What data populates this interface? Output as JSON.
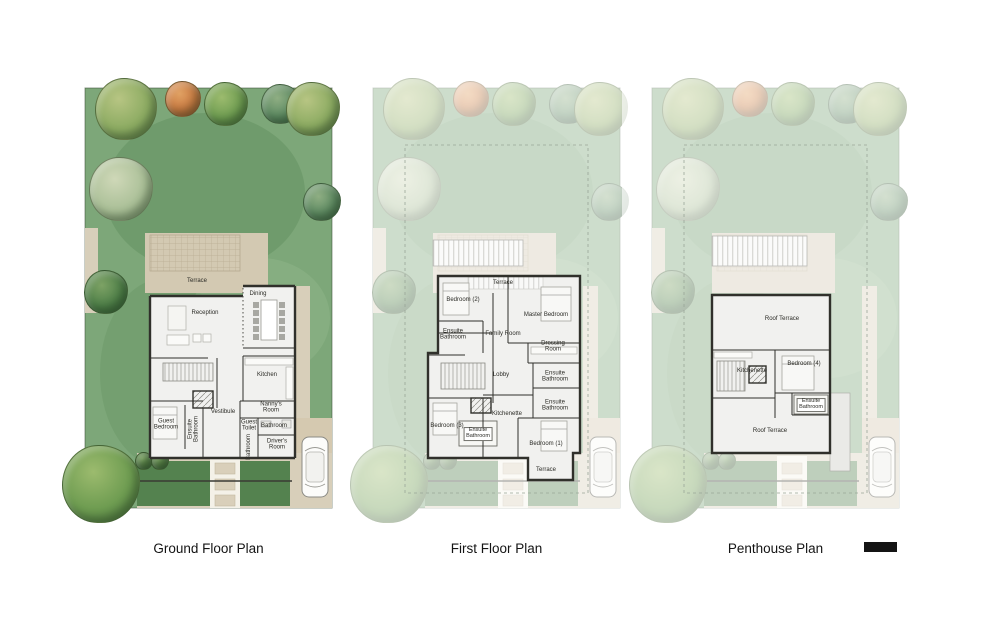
{
  "page": {
    "background": "#ffffff"
  },
  "colors": {
    "page_bg": "#ffffff",
    "lawn": "#7da779",
    "lawn_shade": "#5f8f5e",
    "path_beige": "#d8cfba",
    "terrace_beige": "#d3c9b2",
    "driveway": "#d5c9b0",
    "planting": "#54824f",
    "wall": "#30302b",
    "floor": "#f1f1ef",
    "label_text": "#2b2b26",
    "caption_text": "#141414",
    "wash": "rgba(255,255,255,0.62)",
    "scale_bar": "#141414"
  },
  "plans": [
    {
      "id": "ground",
      "caption": "Ground Floor Plan",
      "faded": false,
      "rooms": [
        {
          "t": "Terrace",
          "x": 142,
          "y": 218
        },
        {
          "t": "Dining",
          "x": 203,
          "y": 231
        },
        {
          "t": "Reception",
          "x": 150,
          "y": 250
        },
        {
          "t": "Kitchen",
          "x": 212,
          "y": 312
        },
        {
          "t": "Vestibule",
          "x": 168,
          "y": 349
        },
        {
          "t": "Guest\nBedroom",
          "x": 111,
          "y": 362
        },
        {
          "t": "Ensuite\nBathroom",
          "x": 139,
          "y": 366,
          "rot": true
        },
        {
          "t": "Guest\nToilet",
          "x": 194,
          "y": 363
        },
        {
          "t": "Bathroom",
          "x": 219,
          "y": 363
        },
        {
          "t": "Nanny's\nRoom",
          "x": 216,
          "y": 345
        },
        {
          "t": "Bathroom",
          "x": 194,
          "y": 384,
          "rot": true
        },
        {
          "t": "Driver's\nRoom",
          "x": 222,
          "y": 382
        }
      ],
      "trees": [
        {
          "x": 70,
          "y": 45,
          "r": 30,
          "c": "l"
        },
        {
          "x": 127,
          "y": 35,
          "r": 17,
          "c": "o"
        },
        {
          "x": 170,
          "y": 40,
          "r": 21,
          "c": "g"
        },
        {
          "x": 225,
          "y": 40,
          "r": 19,
          "c": "t"
        },
        {
          "x": 257,
          "y": 45,
          "r": 26,
          "c": "l"
        },
        {
          "x": 65,
          "y": 125,
          "r": 31,
          "c": "p"
        },
        {
          "x": 50,
          "y": 228,
          "r": 21,
          "c": "d"
        },
        {
          "x": 266,
          "y": 138,
          "r": 18,
          "c": "t"
        },
        {
          "x": 45,
          "y": 420,
          "r": 38,
          "c": "g"
        },
        {
          "x": 88,
          "y": 397,
          "r": 8,
          "c": "b"
        },
        {
          "x": 104,
          "y": 397,
          "r": 8,
          "c": "b"
        }
      ]
    },
    {
      "id": "first",
      "caption": "First Floor Plan",
      "faded": true,
      "rooms": [
        {
          "t": "Terrace",
          "x": 160,
          "y": 220
        },
        {
          "t": "Bedroom (2)",
          "x": 120,
          "y": 237
        },
        {
          "t": "Master Bedroom",
          "x": 203,
          "y": 252
        },
        {
          "t": "Ensuite\nBathroom",
          "x": 110,
          "y": 272
        },
        {
          "t": "Family Room",
          "x": 160,
          "y": 271
        },
        {
          "t": "Dressing\nRoom",
          "x": 210,
          "y": 284
        },
        {
          "t": "Lobby",
          "x": 158,
          "y": 312
        },
        {
          "t": "Ensuite\nBathroom",
          "x": 212,
          "y": 314
        },
        {
          "t": "Ensuite\nBathroom",
          "x": 212,
          "y": 343
        },
        {
          "t": "Kitchenette",
          "x": 164,
          "y": 351
        },
        {
          "t": "Bedroom (3)",
          "x": 104,
          "y": 363
        },
        {
          "t": "Ensuite\nBathroom",
          "x": 135,
          "y": 371,
          "box": true
        },
        {
          "t": "Bedroom (1)",
          "x": 203,
          "y": 381
        },
        {
          "t": "Terrace",
          "x": 203,
          "y": 407
        }
      ],
      "trees": [
        {
          "x": 70,
          "y": 45,
          "r": 30,
          "c": "l"
        },
        {
          "x": 127,
          "y": 35,
          "r": 17,
          "c": "o"
        },
        {
          "x": 170,
          "y": 40,
          "r": 21,
          "c": "g"
        },
        {
          "x": 225,
          "y": 40,
          "r": 19,
          "c": "t"
        },
        {
          "x": 257,
          "y": 45,
          "r": 26,
          "c": "l"
        },
        {
          "x": 65,
          "y": 125,
          "r": 31,
          "c": "p"
        },
        {
          "x": 50,
          "y": 228,
          "r": 21,
          "c": "d"
        },
        {
          "x": 266,
          "y": 138,
          "r": 18,
          "c": "t"
        },
        {
          "x": 45,
          "y": 420,
          "r": 38,
          "c": "g"
        },
        {
          "x": 88,
          "y": 397,
          "r": 8,
          "c": "b"
        },
        {
          "x": 104,
          "y": 397,
          "r": 8,
          "c": "b"
        }
      ]
    },
    {
      "id": "penthouse",
      "caption": "Penthouse Plan",
      "faded": true,
      "rooms": [
        {
          "t": "Roof Terrace",
          "x": 160,
          "y": 256
        },
        {
          "t": "Kitchenette",
          "x": 130,
          "y": 308
        },
        {
          "t": "Bedroom (4)",
          "x": 182,
          "y": 301
        },
        {
          "t": "Ensuite\nBathroom",
          "x": 189,
          "y": 342,
          "box": true
        },
        {
          "t": "Roof Terrace",
          "x": 148,
          "y": 368
        }
      ],
      "trees": [
        {
          "x": 70,
          "y": 45,
          "r": 30,
          "c": "l"
        },
        {
          "x": 127,
          "y": 35,
          "r": 17,
          "c": "o"
        },
        {
          "x": 170,
          "y": 40,
          "r": 21,
          "c": "g"
        },
        {
          "x": 225,
          "y": 40,
          "r": 19,
          "c": "t"
        },
        {
          "x": 257,
          "y": 45,
          "r": 26,
          "c": "l"
        },
        {
          "x": 65,
          "y": 125,
          "r": 31,
          "c": "p"
        },
        {
          "x": 50,
          "y": 228,
          "r": 21,
          "c": "d"
        },
        {
          "x": 266,
          "y": 138,
          "r": 18,
          "c": "t"
        },
        {
          "x": 45,
          "y": 420,
          "r": 38,
          "c": "g"
        },
        {
          "x": 88,
          "y": 397,
          "r": 8,
          "c": "b"
        },
        {
          "x": 104,
          "y": 397,
          "r": 8,
          "c": "b"
        }
      ]
    }
  ]
}
